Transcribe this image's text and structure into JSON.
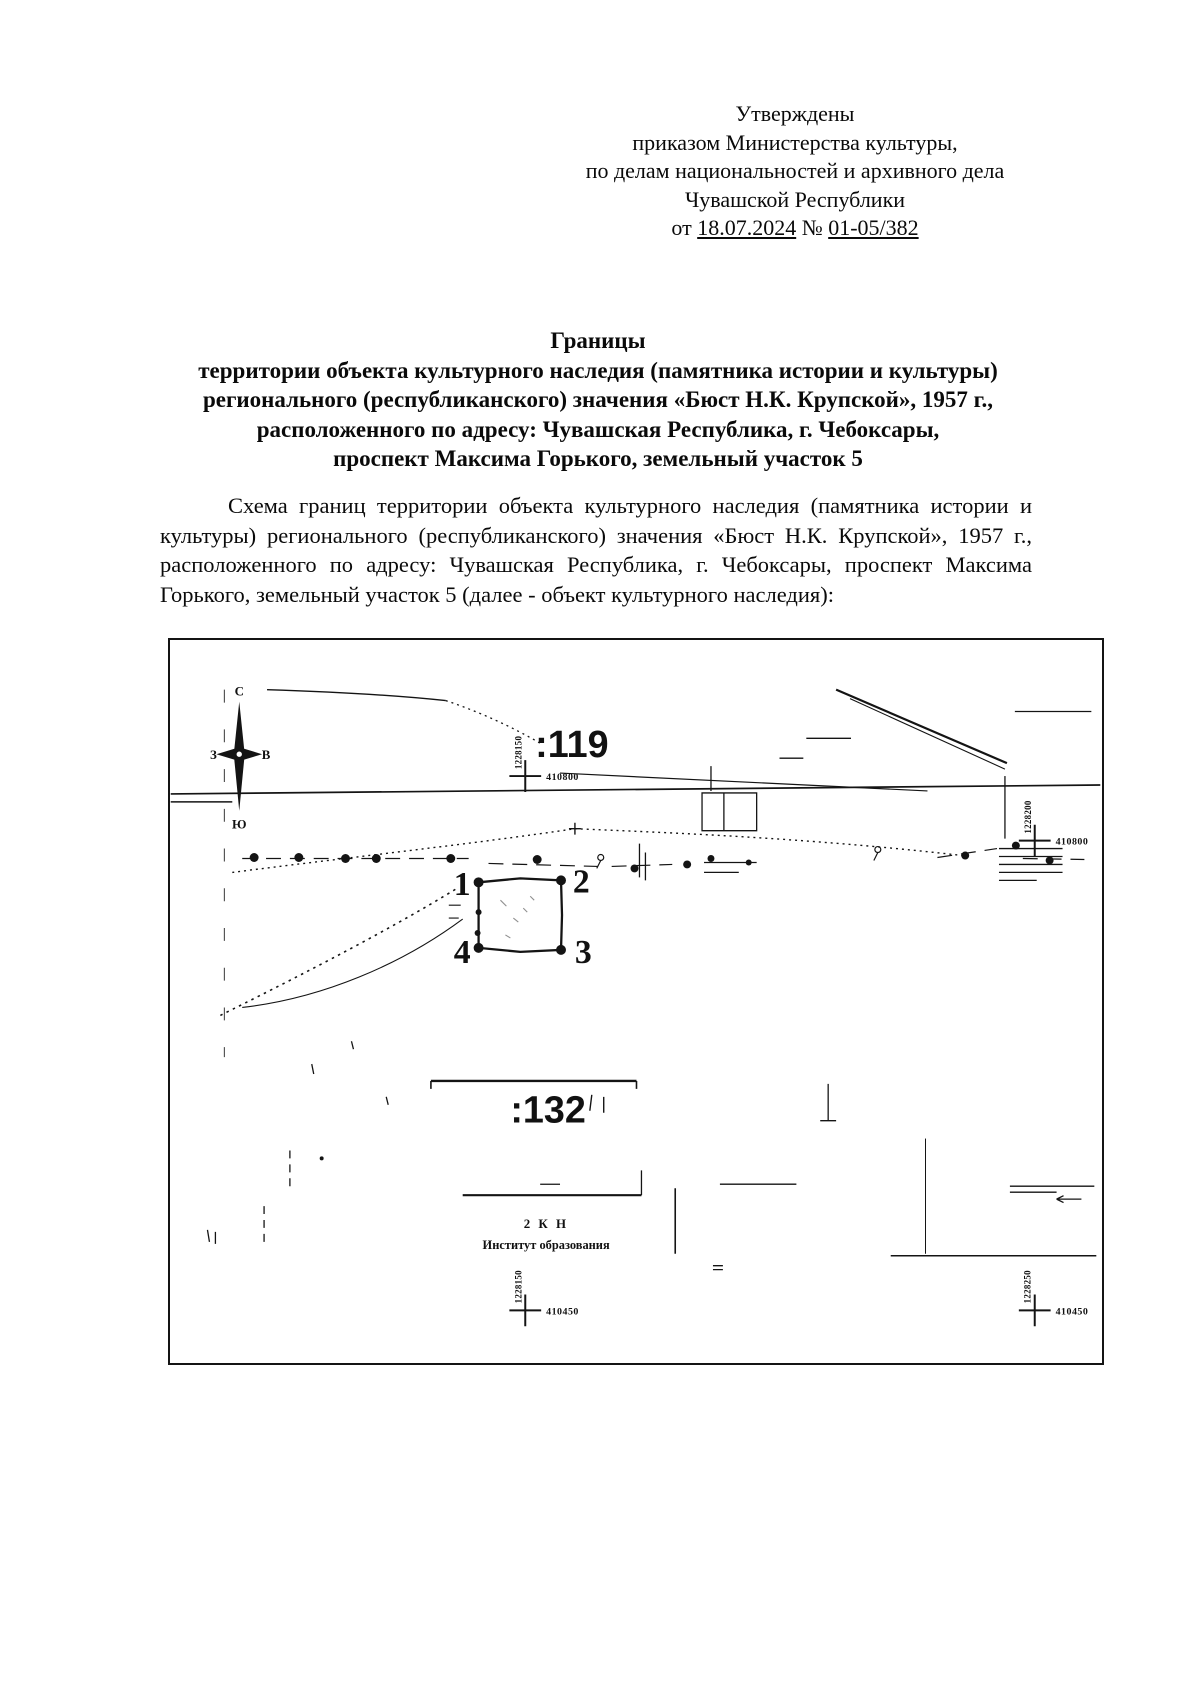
{
  "approval": {
    "line1": "Утверждены",
    "line2": "приказом Министерства культуры,",
    "line3": "по делам национальностей и архивного дела",
    "line4": "Чувашской Республики",
    "date_prefix": "от",
    "date": "18.07.2024",
    "num_sign": "№",
    "number": "01-05/382"
  },
  "title": {
    "line1": "Границы",
    "line2": "территории объекта культурного наследия (памятника истории и культуры)",
    "line3": "регионального (республиканского) значения «Бюст Н.К. Крупской», 1957 г.,",
    "line4": "расположенного по адресу: Чувашская Республика, г. Чебоксары,",
    "line5": "проспект Максима Горького, земельный участок 5"
  },
  "body_paragraph": "Схема границ территории объекта культурного наследия (памятника истории и культуры) регионального (республиканского) значения «Бюст Н.К. Крупской», 1957 г., расположенного по адресу: Чувашская Республика, г. Чебоксары, проспект Максима Горького, земельный участок 5 (далее - объект культурного наследия):",
  "map": {
    "compass": {
      "north": "С",
      "south": "Ю",
      "west": "З",
      "east": "В"
    },
    "parcels": {
      "p119": ":119",
      "p132": ":132"
    },
    "grid_crosses": [
      {
        "easting": "1228150",
        "northing": "410800"
      },
      {
        "easting": "1228200",
        "northing": "410800"
      },
      {
        "easting": "1228150",
        "northing": "410450"
      },
      {
        "easting": "1228250",
        "northing": "410450"
      }
    ],
    "boundary_points": [
      "1",
      "2",
      "3",
      "4"
    ],
    "building_label_line1": "2 К Н",
    "building_label_line2": "Институт образования"
  }
}
